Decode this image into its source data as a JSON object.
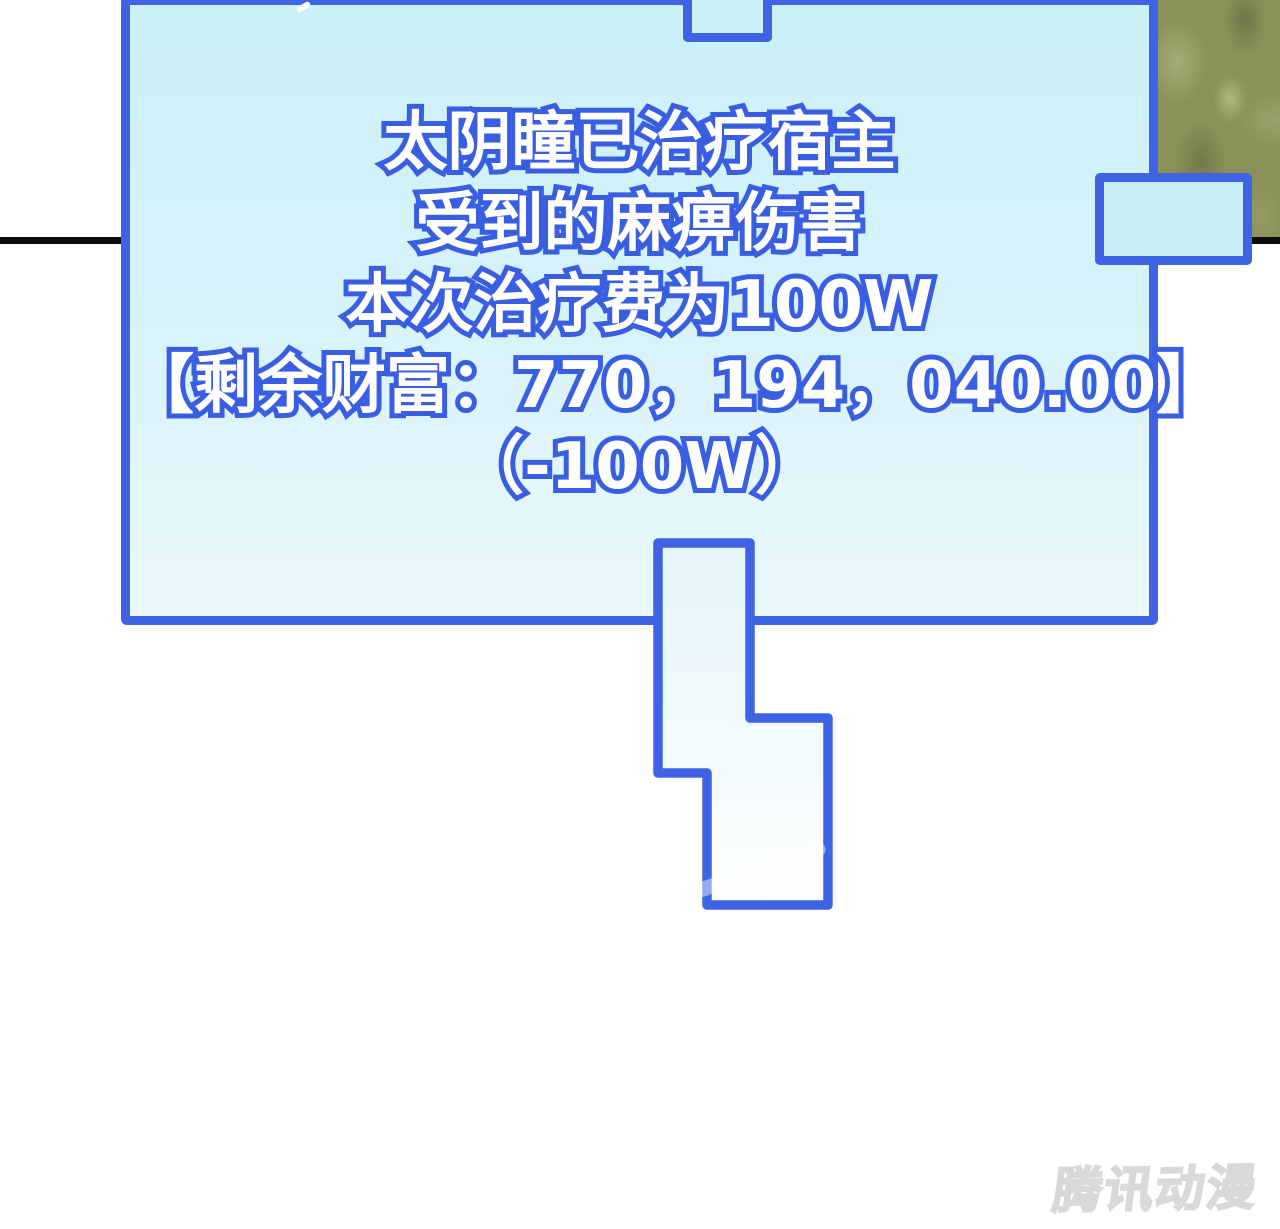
{
  "page": {
    "type": "comic-panel",
    "watermark": "腾讯动漫"
  },
  "dialog": {
    "lines": [
      "太阴瞳已治疗宿主",
      "受到的麻痹伤害",
      "本次治疗费为100W",
      "【剩余财富：770，194，040.00】",
      "（-100W）"
    ]
  },
  "colors": {
    "bubble_border": "#3e63e4",
    "bubble_fill_top": "#cbf0f8",
    "bubble_fill_bottom": "#ebf8fc",
    "text_fill": "#ffffff",
    "text_outline": "#3a5ee2",
    "panel_line": "#0c0c0c",
    "foliage_base": "#8a9259",
    "watermark_outline": "#d9d9d9"
  }
}
